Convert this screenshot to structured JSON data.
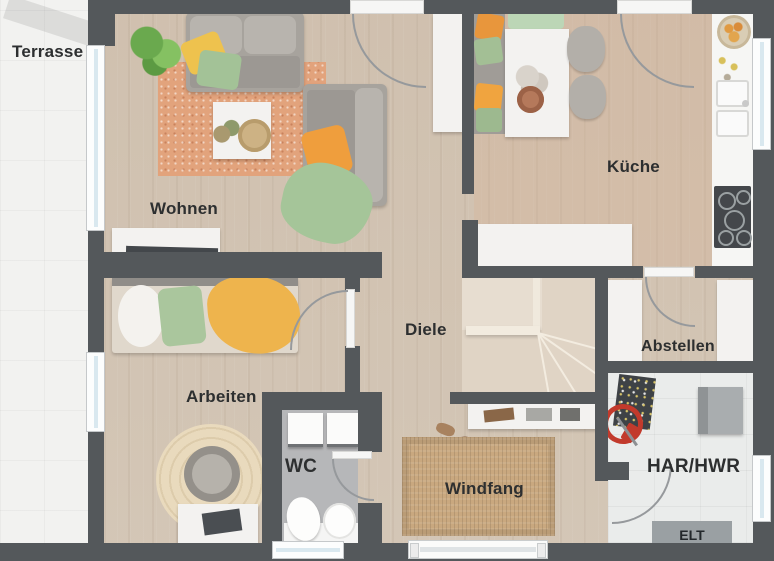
{
  "rooms": {
    "terrasse": {
      "label": "Terrasse"
    },
    "wohnen": {
      "label": "Wohnen"
    },
    "kueche": {
      "label": "Küche"
    },
    "diele": {
      "label": "Diele"
    },
    "abstellen": {
      "label": "Abstellen"
    },
    "arbeiten": {
      "label": "Arbeiten"
    },
    "wc": {
      "label": "WC"
    },
    "windfang": {
      "label": "Windfang"
    },
    "har_hwr": {
      "label": "HAR/HWR"
    },
    "elt": {
      "label": "ELT"
    }
  },
  "colors": {
    "wall": "#54585b",
    "wood_floor": "#d2c5b5",
    "terrace_floor": "#f2f2f0",
    "wc_floor": "#b6b7b9",
    "utility_floor": "#eaeceb",
    "living_rug": "#e2a37c",
    "doormat": "#c9a87f",
    "accent_orange": "#ef9e3d",
    "accent_green": "#a5c599",
    "accent_yellow": "#eec24e",
    "window_glass": "#d9e8ef",
    "label_text": "#2d2f30"
  }
}
